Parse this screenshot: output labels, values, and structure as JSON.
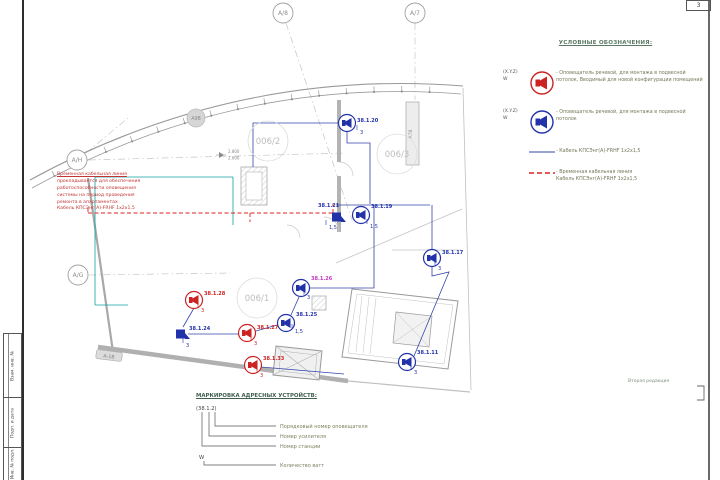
{
  "frame": {
    "page_number": "3",
    "revision_note": "Вторая редакция",
    "stamp_labels": [
      "Взам. инв. №",
      "Подп. и дата",
      "Инв. № подл."
    ]
  },
  "legend": {
    "title": "УСЛОВНЫЕ ОБОЗНАЧЕНИЯ:",
    "items": [
      {
        "tag": "(X.Y.Z)",
        "tag2": "W",
        "symbol": "speaker-red-icon",
        "text": "- Оповещатель речевой, для монтажа в подвесной потолок, Вводимый для новой конфигурации помещений"
      },
      {
        "tag": "(X.Y.Z)",
        "tag2": "W",
        "symbol": "speaker-blue-icon",
        "text": "- Оповещатель речевой, для монтажа в подвесной потолок"
      },
      {
        "tag": "",
        "tag2": "",
        "symbol": "cable-blue-line",
        "text": "- Кабель КПСЭнг(А)-FRHF 1x2x1,5"
      },
      {
        "tag": "",
        "tag2": "",
        "symbol": "cable-red-dashed-line",
        "text": "- Временная кабельная линия\nКабель КПСЭнг(А)-FRHF 1x2x1,5"
      }
    ]
  },
  "marking": {
    "title": "МАРКИРОВКА АДРЕСНЫХ УСТРОЙСТВ:",
    "example": "(38.1.2)",
    "row1": "Порядковый номер оповещателя",
    "row2": "Номер усилителя",
    "row3": "Номер станции",
    "watt_symbol": "W",
    "watt_label": "Количество ватт"
  },
  "annotation": {
    "lines": [
      "Временная кабельная линия",
      "прокладывается для обеспечения",
      "работоспособности оповещения",
      "системы на период проведения",
      "ремонта в апартаментах",
      "Кабель КПСЭнг(А)-FRHF 1x2x1,5"
    ]
  },
  "plan": {
    "axes": [
      {
        "label": "А/8",
        "x": 283,
        "y": 13
      },
      {
        "label": "А/7",
        "x": 415,
        "y": 13
      },
      {
        "label": "А/Н",
        "x": 77,
        "y": 160
      },
      {
        "label": "А/G",
        "x": 78,
        "y": 275
      }
    ],
    "rooms": [
      {
        "label": "006/2",
        "x": 268,
        "y": 141
      },
      {
        "label": "006/3",
        "x": 397,
        "y": 154
      },
      {
        "label": "006/1",
        "x": 257,
        "y": 298
      }
    ],
    "shafts": [
      {
        "label": "А9В",
        "x": 196,
        "y": 118,
        "kind": "circle"
      },
      {
        "label": "А7В",
        "x": 412,
        "y": 134,
        "kind": "vtext"
      },
      {
        "label": "А-1В",
        "x": 109,
        "y": 356,
        "kind": "pill",
        "angle": 7
      }
    ],
    "elevation": {
      "top": "2.800",
      "bottom": "2.600"
    },
    "devices": [
      {
        "label": "38.1.20",
        "watts": "3",
        "x": 347,
        "y": 123,
        "color": "blue",
        "mount": "ceiling",
        "lx": 10,
        "ly": -1,
        "wx": 13,
        "wy": 11
      },
      {
        "label": "38.1.21",
        "watts": "1,5",
        "x": 337,
        "y": 217,
        "color": "blue",
        "mount": "wall",
        "lx": -19,
        "ly": -10,
        "wx": -8,
        "wy": 12
      },
      {
        "label": "38.1.19",
        "watts": "1,5",
        "x": 361,
        "y": 215,
        "color": "blue",
        "mount": "ceiling",
        "lx": 10,
        "ly": -7,
        "wx": 9,
        "wy": 13
      },
      {
        "label": "38.1.17",
        "watts": "3",
        "x": 432,
        "y": 258,
        "color": "blue",
        "mount": "ceiling",
        "lx": 10,
        "ly": -4,
        "wx": 6,
        "wy": 12
      },
      {
        "label": "38.1.11",
        "watts": "3",
        "x": 407,
        "y": 362,
        "color": "blue",
        "mount": "ceiling",
        "lx": 10,
        "ly": -8,
        "wx": 7,
        "wy": 12
      },
      {
        "label": "38.1.26",
        "watts": "3",
        "x": 301,
        "y": 288,
        "color": "blue",
        "mount": "ceiling",
        "lx": 10,
        "ly": -8,
        "wx": 6,
        "wy": 11,
        "label_color": "#c435c4"
      },
      {
        "label": "38.1.25",
        "watts": "1,5",
        "x": 286,
        "y": 323,
        "color": "blue",
        "mount": "ceiling",
        "lx": 10,
        "ly": -7,
        "wx": 9,
        "wy": 10
      },
      {
        "label": "38.1.24",
        "watts": "3",
        "x": 181,
        "y": 334,
        "color": "blue",
        "mount": "wall",
        "lx": 8,
        "ly": -4,
        "wx": 5,
        "wy": 13
      },
      {
        "label": "38.1.28",
        "watts": "3",
        "x": 194,
        "y": 300,
        "color": "red",
        "mount": "ceiling",
        "lx": 10,
        "ly": -5,
        "wx": 7,
        "wy": 12
      },
      {
        "label": "38.1.27",
        "watts": "3",
        "x": 247,
        "y": 333,
        "color": "red",
        "mount": "ceiling",
        "lx": 10,
        "ly": -4,
        "wx": 7,
        "wy": 12
      },
      {
        "label": "38.1.33",
        "watts": "3",
        "x": 253,
        "y": 365,
        "color": "red",
        "mount": "ceiling",
        "lx": 10,
        "ly": -5,
        "wx": 7,
        "wy": 12
      }
    ]
  },
  "colors": {
    "device_blue": "#2233aa",
    "device_red": "#cc2222",
    "cable_blue": "#3344aa",
    "cable_red": "#dd2222",
    "teal": "#11a0a0"
  }
}
